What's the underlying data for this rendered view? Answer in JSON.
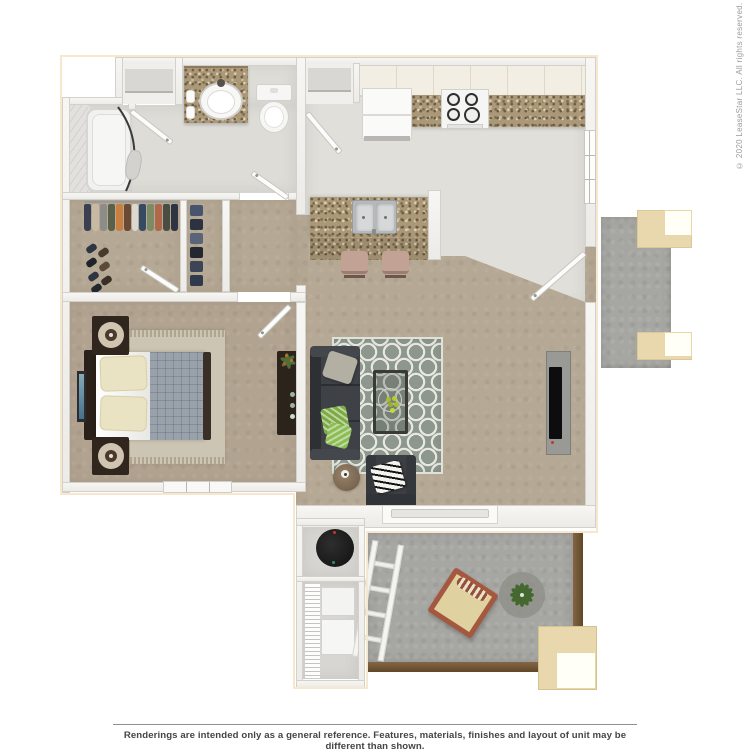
{
  "floorplan": {
    "description": "3D top-down rendering of a one-bedroom, one-bath apartment floor plan",
    "rooms": [
      "bathroom",
      "bathtub-niche",
      "walk-in-closet",
      "linen-closet",
      "hallway",
      "bedroom",
      "kitchen",
      "living-dining-room",
      "entry",
      "water-heater-closet",
      "laundry-closet",
      "lower-patio",
      "upper-balcony"
    ],
    "colors": {
      "background": "#ffffff",
      "plan_outline": "#f6e7cd",
      "wall": "#f4f3f0",
      "wall_edge": "#d3d1cc",
      "carpet_tan": "#b5a894",
      "hard_floor": "#e0dfda",
      "bath_floor": "#dddcd7",
      "patio_concrete": "#a6a6a2",
      "deck_wood_brown": "#74593a",
      "granite_counter": "#ab9878",
      "cabinet_cream": "#f2eee3",
      "sofa_charcoal": "#3e4146",
      "rug_sage": "#8e978e",
      "wood_dark": "#32281f",
      "planter_beige": "#e9d8ae",
      "pillow_green": "#7cab43",
      "chair_frame_red": "#a4583f"
    }
  },
  "copyright": {
    "text": "© 2020 LeaseStar LLC. All rights reserved."
  },
  "footer": {
    "disclaimer": "Renderings are intended only as a general reference. Features, materials, finishes and layout of unit may be different than shown."
  }
}
